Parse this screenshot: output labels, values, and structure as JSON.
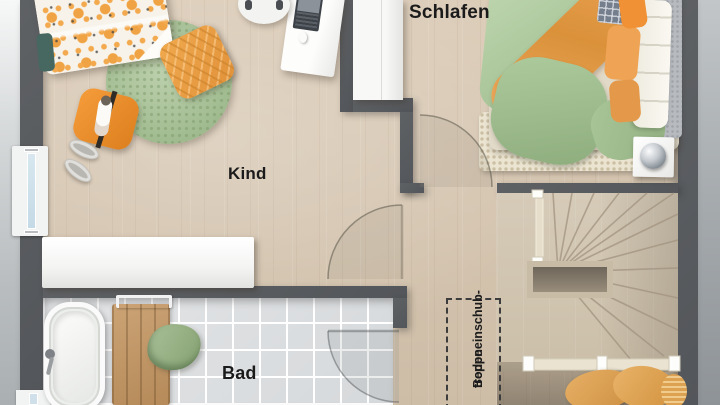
{
  "plan_type": "floor-plan-upper-storey",
  "rooms": [
    {
      "id": "schlafen",
      "label": "Schlafen"
    },
    {
      "id": "kind",
      "label": "Kind"
    },
    {
      "id": "bad",
      "label": "Bad"
    }
  ],
  "annotation": {
    "id": "attic-pull-down-stairs",
    "line1": "Bodeneinschub-",
    "line2": "treppe"
  },
  "colors": {
    "wall": "#565a5d",
    "wood_floor": "#d5c5b0",
    "stair_wood": "#d0c4b0",
    "bath_tile": "#dbdee0",
    "accent_orange": "#ee9a3f",
    "sage_green": "#a3c093",
    "window_glass": "#cfe0ea"
  },
  "furniture": {
    "kind": [
      "kids-bed",
      "round-rug",
      "chevron-cushion",
      "dog-cushion",
      "slippers",
      "desk",
      "desk-chair",
      "laptop",
      "sideboard"
    ],
    "schlafen": [
      "wardrobe",
      "double-bed",
      "headboard",
      "pillows",
      "bedside-rug",
      "nightstand",
      "sphere-lamp"
    ],
    "bad": [
      "bathtub",
      "faucet",
      "wooden-bath-mat",
      "towel",
      "towel-rail"
    ],
    "stairs_area": [
      "winder-staircase",
      "stair-well",
      "guard-rail",
      "laundry-pile"
    ]
  }
}
